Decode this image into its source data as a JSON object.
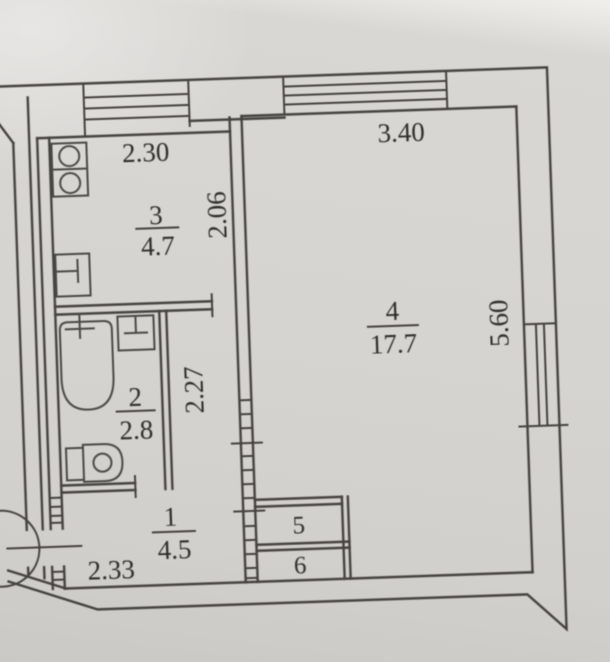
{
  "floor_plan": {
    "title": "apartment-floor-plan-scan",
    "rooms": [
      {
        "id": "kitchen",
        "number": "3",
        "area": "4.7"
      },
      {
        "id": "bathroom",
        "number": "2",
        "area": "2.8"
      },
      {
        "id": "hallway",
        "number": "1",
        "area": "4.5"
      },
      {
        "id": "living-room",
        "number": "4",
        "area": "17.7"
      },
      {
        "id": "closet-top",
        "number": "5"
      },
      {
        "id": "closet-bottom",
        "number": "6"
      }
    ],
    "dimensions": {
      "kitchen_width": "2.30",
      "kitchen_depth": "2.06",
      "living_width": "3.40",
      "living_depth": "5.60",
      "corridor_length": "2.27",
      "hallway_width": "2.33"
    },
    "fixtures": [
      {
        "icon": "stove-icon"
      },
      {
        "icon": "kitchen-sink-icon"
      },
      {
        "icon": "bathtub-icon"
      },
      {
        "icon": "washbasin-icon"
      },
      {
        "icon": "toilet-icon"
      }
    ],
    "colors": {
      "paper": "#d6d4d0",
      "line": "#45433f",
      "text": "#2e2d2b"
    }
  }
}
